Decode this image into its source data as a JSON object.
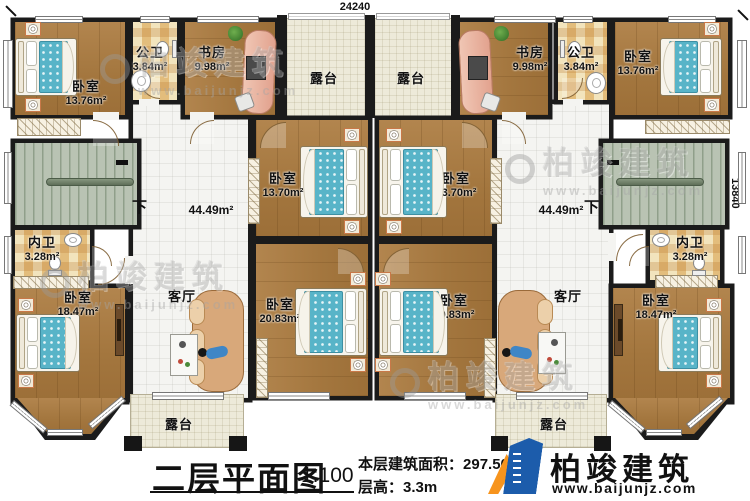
{
  "dimensions": {
    "top": "24240",
    "right": "13840"
  },
  "stairs": {
    "down_label": "下"
  },
  "watermark": {
    "brand": "柏竣建筑",
    "url": "www.baijunjz.com"
  },
  "rooms": {
    "bedroom_tl": {
      "name": "卧室",
      "area": "13.76m²"
    },
    "bath_public_left": {
      "name": "公卫",
      "area": "3.84m²"
    },
    "study_left": {
      "name": "书房",
      "area": "9.98m²"
    },
    "terrace_top_left": {
      "name": "露台"
    },
    "terrace_top_right": {
      "name": "露台"
    },
    "study_right": {
      "name": "书房",
      "area": "9.98m²"
    },
    "bath_public_right": {
      "name": "公卫",
      "area": "3.84m²"
    },
    "bedroom_tr": {
      "name": "卧室",
      "area": "13.76m²"
    },
    "hall_left": {
      "name": "客厅",
      "area": "44.49m²"
    },
    "hall_right": {
      "name": "客厅",
      "area": "44.49m²"
    },
    "bedroom_mid_left": {
      "name": "卧室",
      "area": "13.70m²"
    },
    "bedroom_mid_right": {
      "name": "卧室",
      "area": "13.70m²"
    },
    "bath_inner_left": {
      "name": "内卫",
      "area": "3.28m²"
    },
    "bath_inner_right": {
      "name": "内卫",
      "area": "3.28m²"
    },
    "bedroom_bottom_left": {
      "name": "卧室",
      "area": "18.47m²"
    },
    "bedroom_bottom_center_left": {
      "name": "卧室",
      "area": "20.83m²"
    },
    "bedroom_bottom_center_right": {
      "name": "卧室",
      "area": "20.83m²"
    },
    "bedroom_bottom_right": {
      "name": "卧室",
      "area": "18.47m²"
    },
    "terrace_bottom_left": {
      "name": "露台"
    },
    "terrace_bottom_right": {
      "name": "露台"
    }
  },
  "title_block": {
    "title": "二层平面图",
    "scale": "1:100",
    "area_label": "本层建筑面积：",
    "area_value": "297.50m²",
    "floor_height_label": "层高：",
    "floor_height_value": "3.3m"
  },
  "logo": {
    "brand": "柏竣建筑",
    "url": "www.baijunjz.com"
  }
}
